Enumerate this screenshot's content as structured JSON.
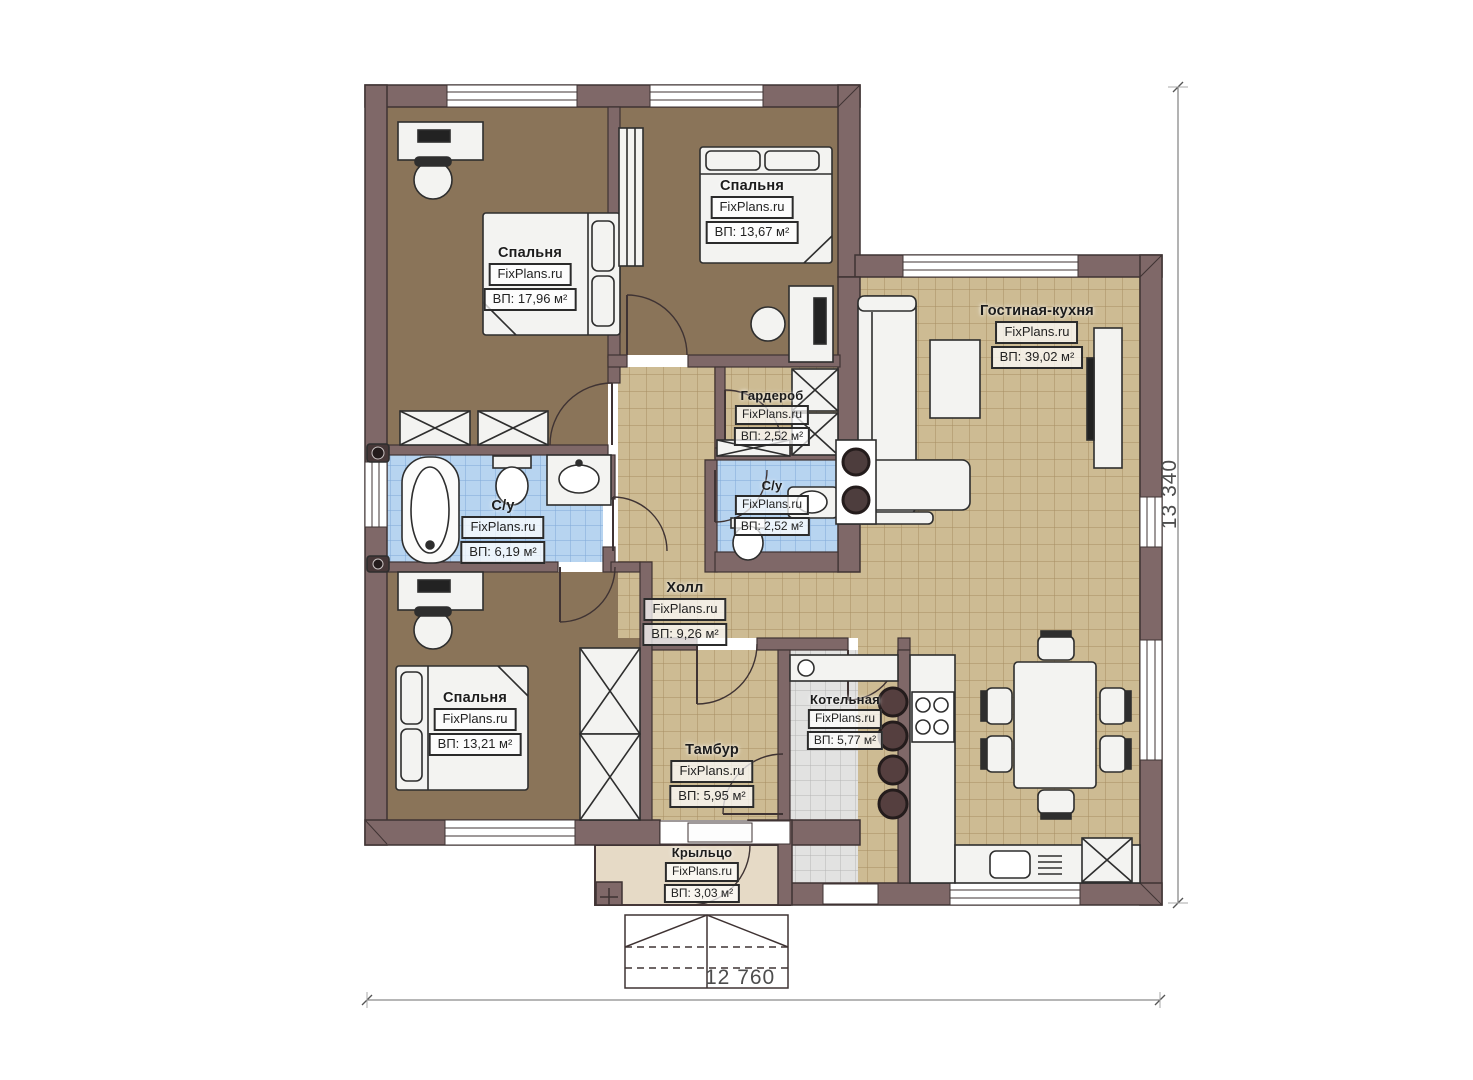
{
  "plan": {
    "brand": "FixPlans.ru",
    "rooms": [
      {
        "name": "Спальня",
        "brand": "FixPlans.ru",
        "area": "ВП: 17,96 м²"
      },
      {
        "name": "Спальня",
        "brand": "FixPlans.ru",
        "area": "ВП: 13,67 м²"
      },
      {
        "name": "Гостиная-кухня",
        "brand": "FixPlans.ru",
        "area": "ВП: 39,02 м²"
      },
      {
        "name": "Гардероб",
        "brand": "FixPlans.ru",
        "area": "ВП: 2,52 м²"
      },
      {
        "name": "С/у",
        "brand": "FixPlans.ru",
        "area": "ВП: 6,19 м²"
      },
      {
        "name": "С/у",
        "brand": "FixPlans.ru",
        "area": "ВП: 2,52 м²"
      },
      {
        "name": "Холл",
        "brand": "FixPlans.ru",
        "area": "ВП: 9,26 м²"
      },
      {
        "name": "Спальня",
        "brand": "FixPlans.ru",
        "area": "ВП: 13,21 м²"
      },
      {
        "name": "Котельная",
        "brand": "FixPlans.ru",
        "area": "ВП: 5,77 м²"
      },
      {
        "name": "Тамбур",
        "brand": "FixPlans.ru",
        "area": "ВП: 5,95 м²"
      },
      {
        "name": "Крыльцо",
        "brand": "FixPlans.ru",
        "area": "ВП: 3,03 м²"
      }
    ],
    "dimensions": {
      "bottom": "12 760",
      "right": "13 340"
    },
    "colors": {
      "wall": "#7f6868",
      "wall_outline": "#3f3333",
      "bedroom_floor": "#8a7459",
      "tile_tan": "#cdbb93",
      "tile_blue": "#b7d4f0",
      "tile_gray": "#e2e2e1",
      "porch": "#e6dac6",
      "furniture": "#f3f3f1"
    }
  }
}
